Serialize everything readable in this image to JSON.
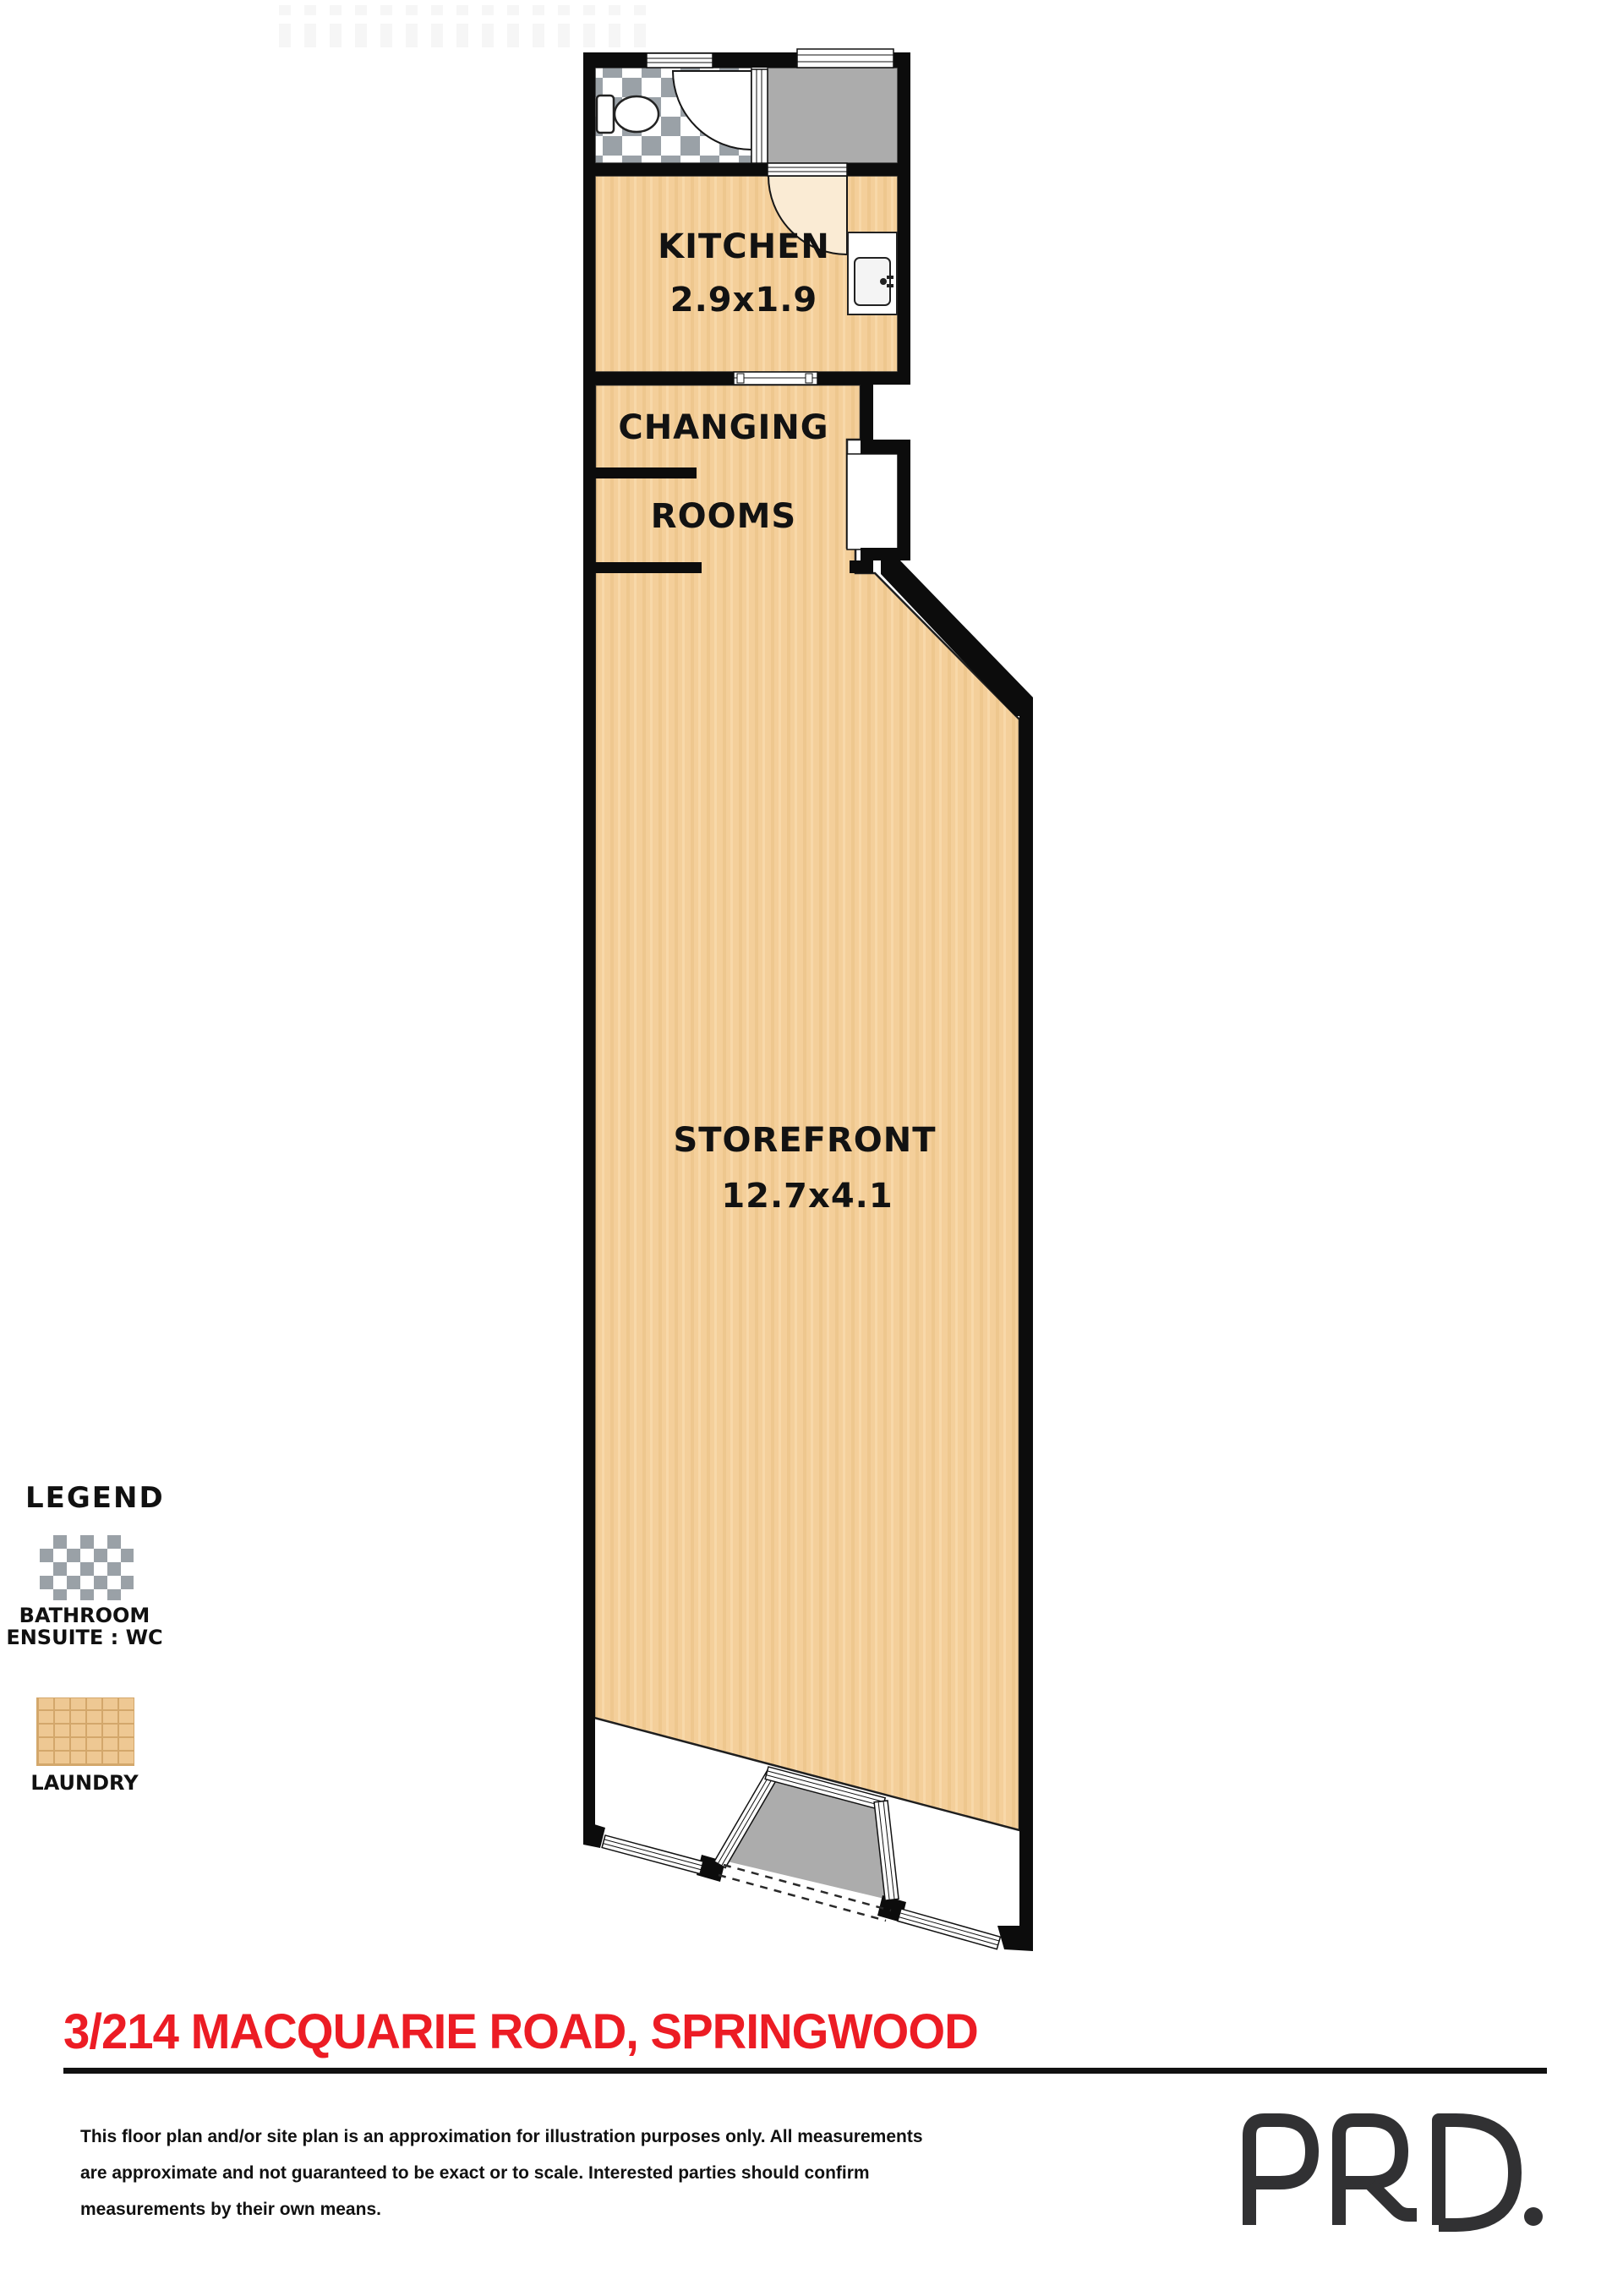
{
  "title_address": "3/214 MACQUARIE ROAD, SPRINGWOOD",
  "floor_plan": {
    "kitchen": {
      "label": "KITCHEN",
      "dims": "2.9x1.9"
    },
    "changing_rooms": {
      "label_line1": "CHANGING",
      "label_line2": "ROOMS"
    },
    "storefront": {
      "label": "STOREFRONT",
      "dims": "12.7x4.1"
    }
  },
  "legend": {
    "title": "LEGEND",
    "bathroom": {
      "line1": "BATHROOM",
      "line2": "ENSUITE : WC",
      "swatch": "checkered-tile-swatch"
    },
    "laundry": {
      "label": "LAUNDRY",
      "swatch": "tan-tile-swatch"
    }
  },
  "disclaimer": {
    "line1": "This floor plan and/or site plan is an approximation for illustration purposes only. All measurements",
    "line2": "are approximate and not guaranteed to be exact or to scale. Interested parties should confirm",
    "line3": "measurements by their own means."
  },
  "branding": {
    "logo_text": "PRD."
  },
  "colors": {
    "floor_tan": "#F4CF9A",
    "room_gray": "#ACACAC",
    "checker_gray": "#9AA1A7",
    "laundry_tan": "#EEC893",
    "wall_black": "#0C0C0C",
    "address_red": "#EC1C24",
    "logo_gray": "#313133"
  }
}
